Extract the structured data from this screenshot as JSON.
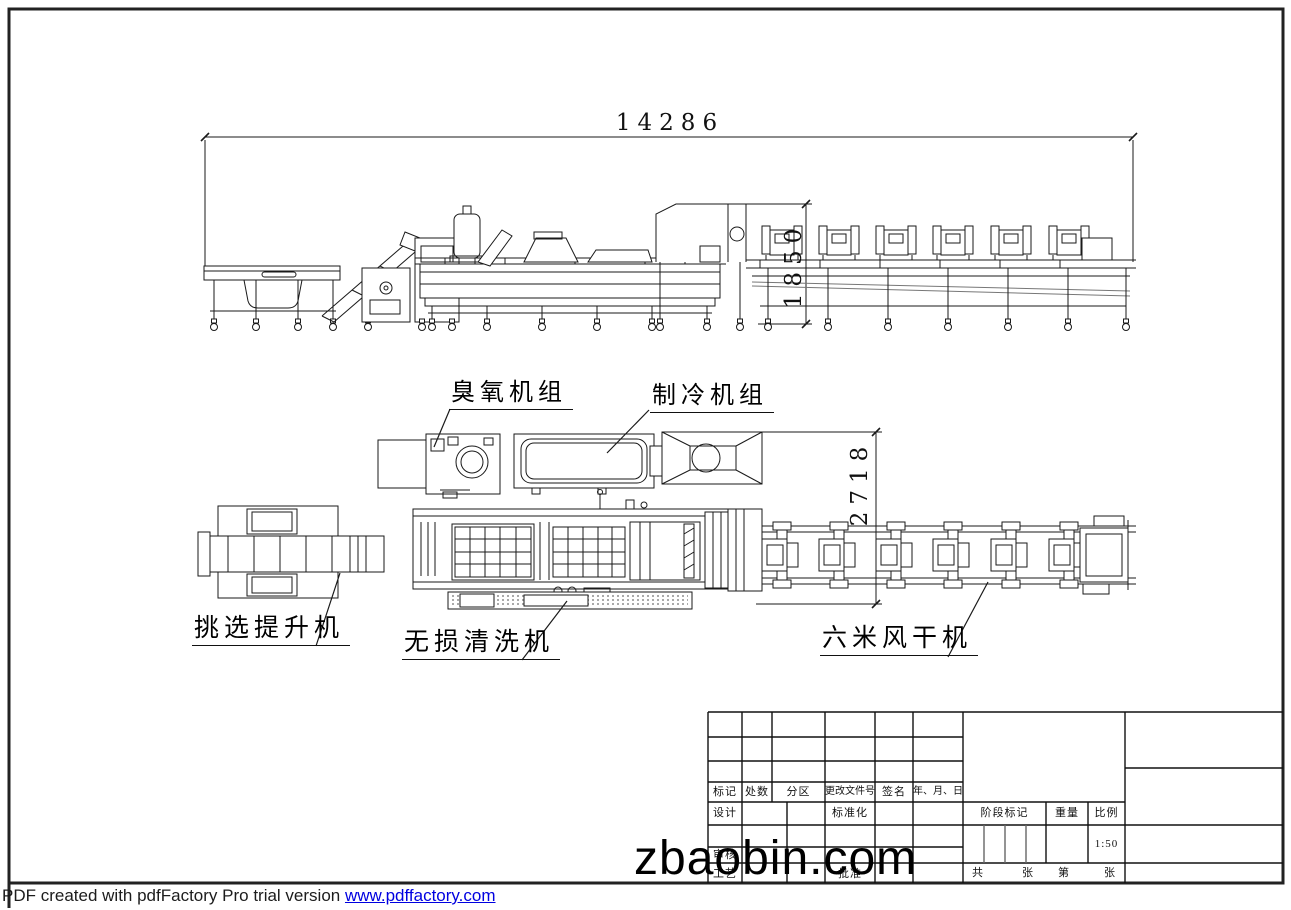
{
  "page": {
    "watermark": "zbaobin.com",
    "footer": {
      "text": "PDF created with pdfFactory Pro trial version ",
      "link": "www.pdffactory.com"
    }
  },
  "drawing": {
    "dimensions": {
      "overall_length": "14286",
      "dryer_height": "1850",
      "line_width": "2718"
    },
    "labels": {
      "ozone_unit": "臭氧机组",
      "chiller_unit": "制冷机组",
      "sorting_elevator": "挑选提升机",
      "washer": "无损清洗机",
      "dryer": "六米风干机"
    }
  },
  "title_block": {
    "revision_header": [
      "标记",
      "处数",
      "分区",
      "更改文件号",
      "签名",
      "年、月、日"
    ],
    "design": "设计",
    "standardization": "标准化",
    "review": "审核",
    "process": "工艺",
    "approve": "批准",
    "stage_mark": "阶段标记",
    "weight": "重量",
    "scale_label": "比例",
    "scale_value": "1:50",
    "sheet": [
      "共",
      "张",
      "第",
      "张"
    ]
  },
  "colors": {
    "line": "#1a1a1a",
    "link_blue": "#0000e0"
  }
}
